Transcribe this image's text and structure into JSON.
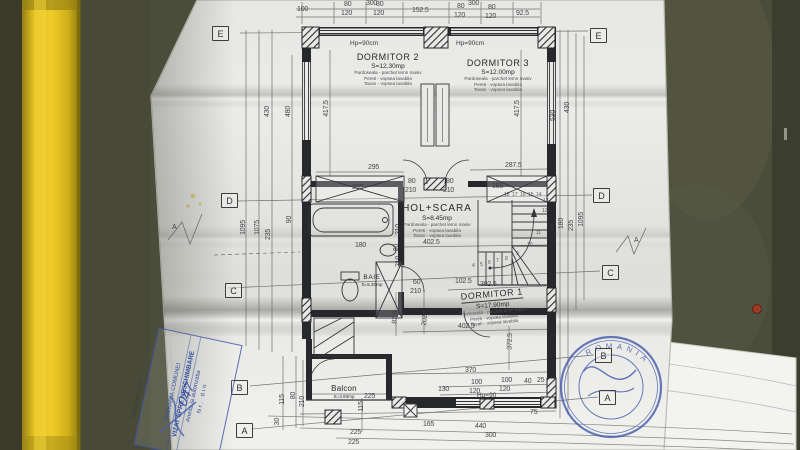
{
  "photo": {
    "background_color": "#4b4d3b",
    "yellow_bar_color": "#f0cd2a",
    "paper_color": "#e8e8e5",
    "stamp_blue": "#34509f"
  },
  "plan": {
    "rooms": [
      {
        "name": "DORMITOR 2",
        "area": "S=12.30mp",
        "f1": "Pardoseala - parchet lemn masiv",
        "f2": "Pereti - vopsea lavabila",
        "f3": "Tavan - vopsea lavabila"
      },
      {
        "name": "DORMITOR 3",
        "area": "S=12.00mp",
        "f1": "Pardoseala - parchet lemn masiv",
        "f2": "Pereti - vopsea lavabila",
        "f3": "Tavan - vopsea lavabila"
      },
      {
        "name": "HOL+SCARA",
        "area": "S=8.45mp",
        "f1": "Pardoseala - parchet lemn masiv",
        "f2": "Pereti - vopsea lavabila",
        "f3": "Tavan - vopsea lavabila"
      },
      {
        "name": "BAIE",
        "area": "S=5.30mp"
      },
      {
        "name": "DORMITOR 1",
        "area": "S=17.90mp",
        "f1": "Pardoseala - parchet lemn masiv",
        "f2": "Pereti - vopsea lavabila",
        "f3": "Tavan - vopsea lavabila"
      },
      {
        "name": "Balcon",
        "area": "S=3.60mp"
      }
    ],
    "window_labels": [
      {
        "t": "Hp=90cm",
        "x": 350,
        "y": 41
      },
      {
        "t": "Hp=90cm",
        "x": 456,
        "y": 41
      },
      {
        "t": "Hp=90",
        "x": 477,
        "y": 393
      }
    ],
    "grid_boxes": [
      {
        "t": "E",
        "x": 212,
        "y": 26
      },
      {
        "t": "D",
        "x": 221,
        "y": 193
      },
      {
        "t": "C",
        "x": 225,
        "y": 283
      },
      {
        "t": "B",
        "x": 231,
        "y": 380
      },
      {
        "t": "A",
        "x": 236,
        "y": 423
      },
      {
        "t": "E",
        "x": 590,
        "y": 28
      },
      {
        "t": "D",
        "x": 593,
        "y": 188
      },
      {
        "t": "C",
        "x": 602,
        "y": 265
      },
      {
        "t": "B",
        "x": 595,
        "y": 348
      },
      {
        "t": "A",
        "x": 599,
        "y": 390
      }
    ],
    "stair_numbers": [
      {
        "t": "18",
        "x": 504,
        "y": 193
      },
      {
        "t": "17",
        "x": 512,
        "y": 193
      },
      {
        "t": "16",
        "x": 520,
        "y": 193
      },
      {
        "t": "15",
        "x": 528,
        "y": 193
      },
      {
        "t": "14",
        "x": 536,
        "y": 193
      },
      {
        "t": "13",
        "x": 543,
        "y": 199
      },
      {
        "t": "12",
        "x": 542,
        "y": 209
      },
      {
        "t": "11",
        "x": 536,
        "y": 231
      },
      {
        "t": "10",
        "x": 527,
        "y": 243
      },
      {
        "t": "9",
        "x": 516,
        "y": 252
      },
      {
        "t": "8",
        "x": 505,
        "y": 257
      },
      {
        "t": "7",
        "x": 496,
        "y": 259
      },
      {
        "t": "6",
        "x": 488,
        "y": 261
      },
      {
        "t": "5",
        "x": 480,
        "y": 263
      },
      {
        "t": "4",
        "x": 472,
        "y": 264
      }
    ],
    "dim_labels": [
      {
        "t": "300",
        "x": 366,
        "y": 0
      },
      {
        "t": "300",
        "x": 468,
        "y": 0
      },
      {
        "t": "100",
        "x": 297,
        "y": 6
      },
      {
        "t": "80",
        "x": 344,
        "y": 1
      },
      {
        "t": "120",
        "x": 341,
        "y": 10
      },
      {
        "t": "80",
        "x": 376,
        "y": 1
      },
      {
        "t": "120",
        "x": 373,
        "y": 10
      },
      {
        "t": "152.5",
        "x": 412,
        "y": 7
      },
      {
        "t": "80",
        "x": 457,
        "y": 3
      },
      {
        "t": "120",
        "x": 454,
        "y": 12
      },
      {
        "t": "80",
        "x": 488,
        "y": 4
      },
      {
        "t": "120",
        "x": 485,
        "y": 13
      },
      {
        "t": "92.5",
        "x": 516,
        "y": 10
      },
      {
        "t": "430",
        "x": 262,
        "y": 108,
        "r": -90
      },
      {
        "t": "480",
        "x": 283,
        "y": 108,
        "r": -90
      },
      {
        "t": "417.5",
        "x": 318,
        "y": 105,
        "r": -90
      },
      {
        "t": "417.5",
        "x": 509,
        "y": 105,
        "r": -90
      },
      {
        "t": "530",
        "x": 548,
        "y": 112,
        "r": -90
      },
      {
        "t": "430",
        "x": 562,
        "y": 104,
        "r": -90
      },
      {
        "t": "1095",
        "x": 236,
        "y": 224,
        "r": -90
      },
      {
        "t": "1075",
        "x": 250,
        "y": 224,
        "r": -90
      },
      {
        "t": "235",
        "x": 263,
        "y": 231,
        "r": -90
      },
      {
        "t": "90",
        "x": 286,
        "y": 216,
        "r": -90
      },
      {
        "t": "80",
        "x": 549,
        "y": 224,
        "r": -90
      },
      {
        "t": "180",
        "x": 556,
        "y": 220,
        "r": -90
      },
      {
        "t": "235",
        "x": 566,
        "y": 222,
        "r": -90
      },
      {
        "t": "1095",
        "x": 574,
        "y": 216,
        "r": -90
      },
      {
        "t": "295",
        "x": 368,
        "y": 164
      },
      {
        "t": "287.5",
        "x": 505,
        "y": 162
      },
      {
        "t": "200",
        "x": 352,
        "y": 184
      },
      {
        "t": "185",
        "x": 492,
        "y": 183
      },
      {
        "t": "80",
        "x": 408,
        "y": 178
      },
      {
        "t": "210",
        "x": 405,
        "y": 187
      },
      {
        "t": "80",
        "x": 446,
        "y": 178
      },
      {
        "t": "210",
        "x": 443,
        "y": 187
      },
      {
        "t": "210",
        "x": 393,
        "y": 226,
        "r": -90
      },
      {
        "t": "80",
        "x": 393,
        "y": 244,
        "r": -90
      },
      {
        "t": "210",
        "x": 393,
        "y": 258,
        "r": -90
      },
      {
        "t": "180",
        "x": 355,
        "y": 242
      },
      {
        "t": "402.5",
        "x": 423,
        "y": 239
      },
      {
        "t": "60",
        "x": 413,
        "y": 279
      },
      {
        "t": "210",
        "x": 410,
        "y": 288
      },
      {
        "t": "102.5",
        "x": 455,
        "y": 278
      },
      {
        "t": "302.5",
        "x": 480,
        "y": 281
      },
      {
        "t": "87.5",
        "x": 389,
        "y": 314,
        "r": -85
      },
      {
        "t": "202.5",
        "x": 417,
        "y": 314,
        "r": -85
      },
      {
        "t": "402.5",
        "x": 458,
        "y": 323
      },
      {
        "t": "372.5",
        "x": 502,
        "y": 338,
        "r": -88
      },
      {
        "t": "370",
        "x": 465,
        "y": 367
      },
      {
        "t": "130",
        "x": 438,
        "y": 386
      },
      {
        "t": "100",
        "x": 471,
        "y": 379
      },
      {
        "t": "120",
        "x": 469,
        "y": 388
      },
      {
        "t": "100",
        "x": 501,
        "y": 377
      },
      {
        "t": "120",
        "x": 499,
        "y": 386
      },
      {
        "t": "40",
        "x": 524,
        "y": 378
      },
      {
        "t": "25",
        "x": 537,
        "y": 377
      },
      {
        "t": "75",
        "x": 530,
        "y": 409
      },
      {
        "t": "165",
        "x": 423,
        "y": 421
      },
      {
        "t": "440",
        "x": 475,
        "y": 423
      },
      {
        "t": "300",
        "x": 485,
        "y": 432
      },
      {
        "t": "225",
        "x": 350,
        "y": 429
      },
      {
        "t": "225",
        "x": 348,
        "y": 439
      },
      {
        "t": "225",
        "x": 364,
        "y": 393
      },
      {
        "t": "115",
        "x": 356,
        "y": 403,
        "r": -90
      },
      {
        "t": "115",
        "x": 277,
        "y": 396,
        "r": -90
      },
      {
        "t": "80",
        "x": 290,
        "y": 392,
        "r": -90
      },
      {
        "t": "210",
        "x": 297,
        "y": 398,
        "r": -90
      },
      {
        "t": "30",
        "x": 274,
        "y": 418,
        "r": -90
      },
      {
        "t": "A",
        "x": 172,
        "y": 224
      },
      {
        "t": "A",
        "x": 634,
        "y": 237
      }
    ]
  },
  "stamps": {
    "approval": {
      "line1": "PRIMARIA COMUNEI",
      "line2": "VIZAT SPRE NESCHIMBARE",
      "line3": "Anexa la autorizatia",
      "line4": "Nr.      din",
      "handwritten": "047"
    },
    "signature_label": "Arhitect-sef",
    "round_seal_text": "ROMANIA"
  }
}
